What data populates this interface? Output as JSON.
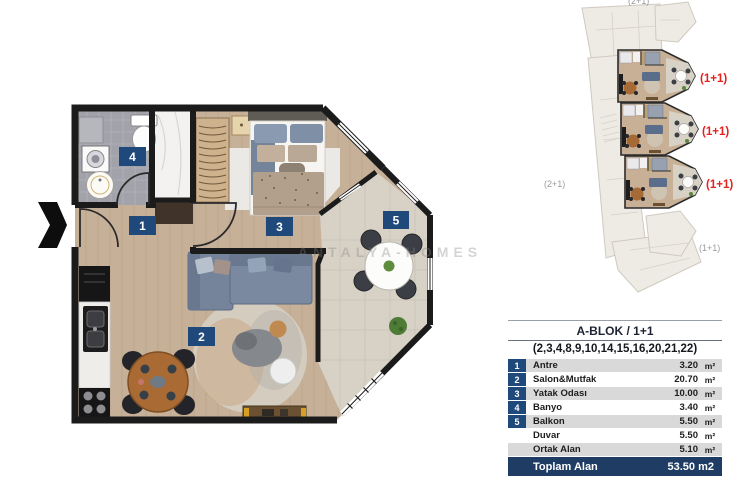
{
  "colors": {
    "badge_navy": "#20497b",
    "table_navy": "#1e3c64",
    "red_label": "#e3221e",
    "wood_floor": "#c6b098",
    "wall_black": "#1b1b1b",
    "balcony_stone": "#d8d2c6",
    "bath_gray": "#a2a2aa"
  },
  "plan": {
    "badges": [
      "1",
      "2",
      "3",
      "4",
      "5"
    ],
    "watermark": "ANTALYA-HOMES"
  },
  "key_plan": {
    "red_labels": [
      "(1+1)",
      "(1+1)",
      "(1+1)"
    ],
    "gray_labels": [
      "(2+1)",
      "(2+1)",
      "(1+1)"
    ]
  },
  "table": {
    "title": "A-BLOK / 1+1",
    "subtitle": "(2,3,4,8,9,10,14,15,16,20,21,22)",
    "rows": [
      {
        "num": "1",
        "name": "Antre",
        "value": "3.20",
        "unit": "m²"
      },
      {
        "num": "2",
        "name": "Salon&Mutfak",
        "value": "20.70",
        "unit": "m²"
      },
      {
        "num": "3",
        "name": "Yatak Odası",
        "value": "10.00",
        "unit": "m²"
      },
      {
        "num": "4",
        "name": "Banyo",
        "value": "3.40",
        "unit": "m²"
      },
      {
        "num": "5",
        "name": "Balkon",
        "value": "5.50",
        "unit": "m²"
      },
      {
        "num": "",
        "name": "Duvar",
        "value": "5.50",
        "unit": "m²"
      },
      {
        "num": "",
        "name": "Ortak Alan",
        "value": "5.10",
        "unit": "m²"
      }
    ],
    "total": {
      "name": "Toplam Alan",
      "value": "53.50 m2"
    }
  }
}
